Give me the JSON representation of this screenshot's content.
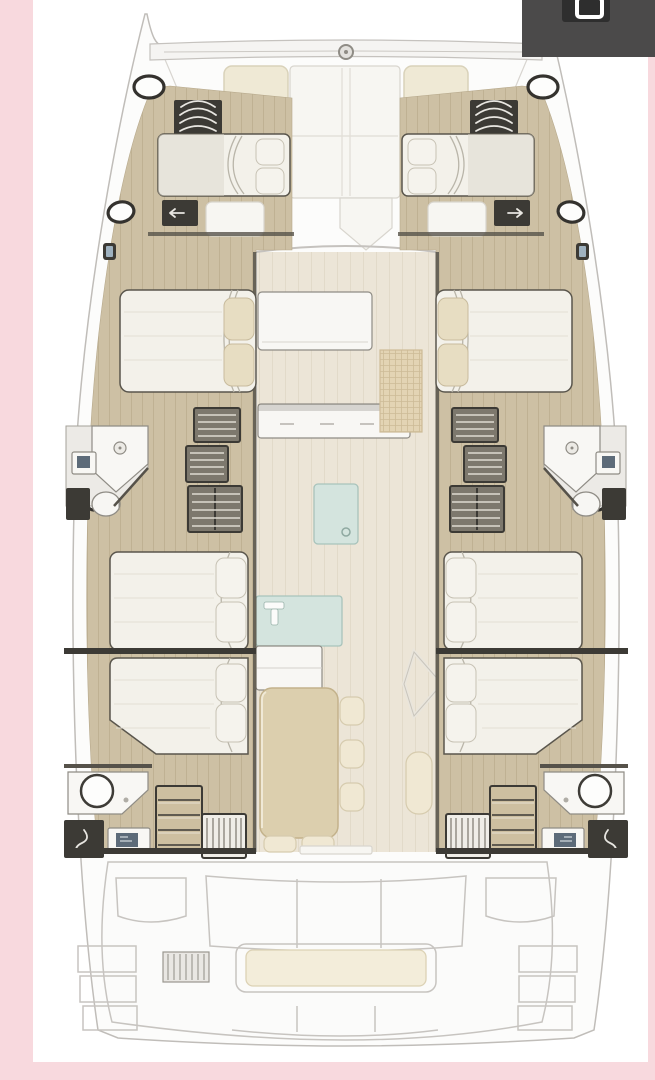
{
  "window": {
    "width": 655,
    "height": 1080
  },
  "frame": {
    "pink_border": "#f8d9de"
  },
  "overlay": {
    "panel_color": "#4b4a4a",
    "button_color": "#2e2e2e",
    "icon": "rounded-square-icon",
    "icon_color": "#ffffff"
  },
  "floor_plan": {
    "type": "catamaran-yacht-deck-plan",
    "orientation": "bow-up",
    "features": [
      "forward crossbeam with windlass",
      "foredeck sun pads",
      "port forward cabin with double bed",
      "starboard forward cabin with double bed",
      "port mid cabin with island bed",
      "starboard mid cabin with island bed",
      "port mid bathroom with sink and toilet",
      "starboard mid bathroom with sink and toilet",
      "galley island and counters",
      "sink unit with glass top",
      "dining table with stools",
      "port aft cabins with two beds",
      "starboard aft cabins with two beds",
      "port aft bathroom with shower",
      "starboard aft bathroom with shower",
      "aft cockpit bench with cushion",
      "transom steps"
    ]
  },
  "colors": {
    "page_bg": "#ffffff",
    "frame_pink": "#f8d9de",
    "overlay_panel": "#4b4a4a",
    "overlay_button": "#2e2e2e",
    "overlay_icon": "#ffffff",
    "hull_fill": "#fcfcfb",
    "hull_stroke": "#c0bdb9",
    "deck_line": "#d8d5d0",
    "wood_floor": "#cdc0a4",
    "wood_stripe": "#bfb193",
    "salon_floor": "#ece5d7",
    "salon_stripe": "#e2dac9",
    "wall_dark": "#3c3a35",
    "wall_mid": "#56524a",
    "bed_fill": "#f3f1ea",
    "bed_stroke": "#5a564d",
    "bed_shade": "#dcd8cc",
    "bed_crease": "#b9b5a9",
    "pillow_fill": "#e7ddc2",
    "pillow_stroke": "#c8bb9d",
    "drawer_face": "#7d786d",
    "drawer_stripe": "#dfdbd2",
    "counter_fill": "#f8f7f4",
    "counter_stroke": "#8f8c85",
    "teal_fill": "#d4e4de",
    "teal_stroke": "#a8c3bb",
    "table_fill": "#dccfae",
    "table_stroke": "#c3b28b",
    "stool_fill": "#f0e8d3",
    "stool_stroke": "#d6cbae",
    "mat_fill": "#e3d4b4",
    "mat_line": "#cdbb96",
    "pad_fill": "#efe9d5",
    "pad_stroke": "#d9d2ba",
    "porthole_ring": "#34322e",
    "cockpit_line": "#c7c4c0",
    "cushion_fill": "#f3edda",
    "cushion_stroke": "#dcd2b5",
    "screen_blue": "#5d6b79"
  }
}
